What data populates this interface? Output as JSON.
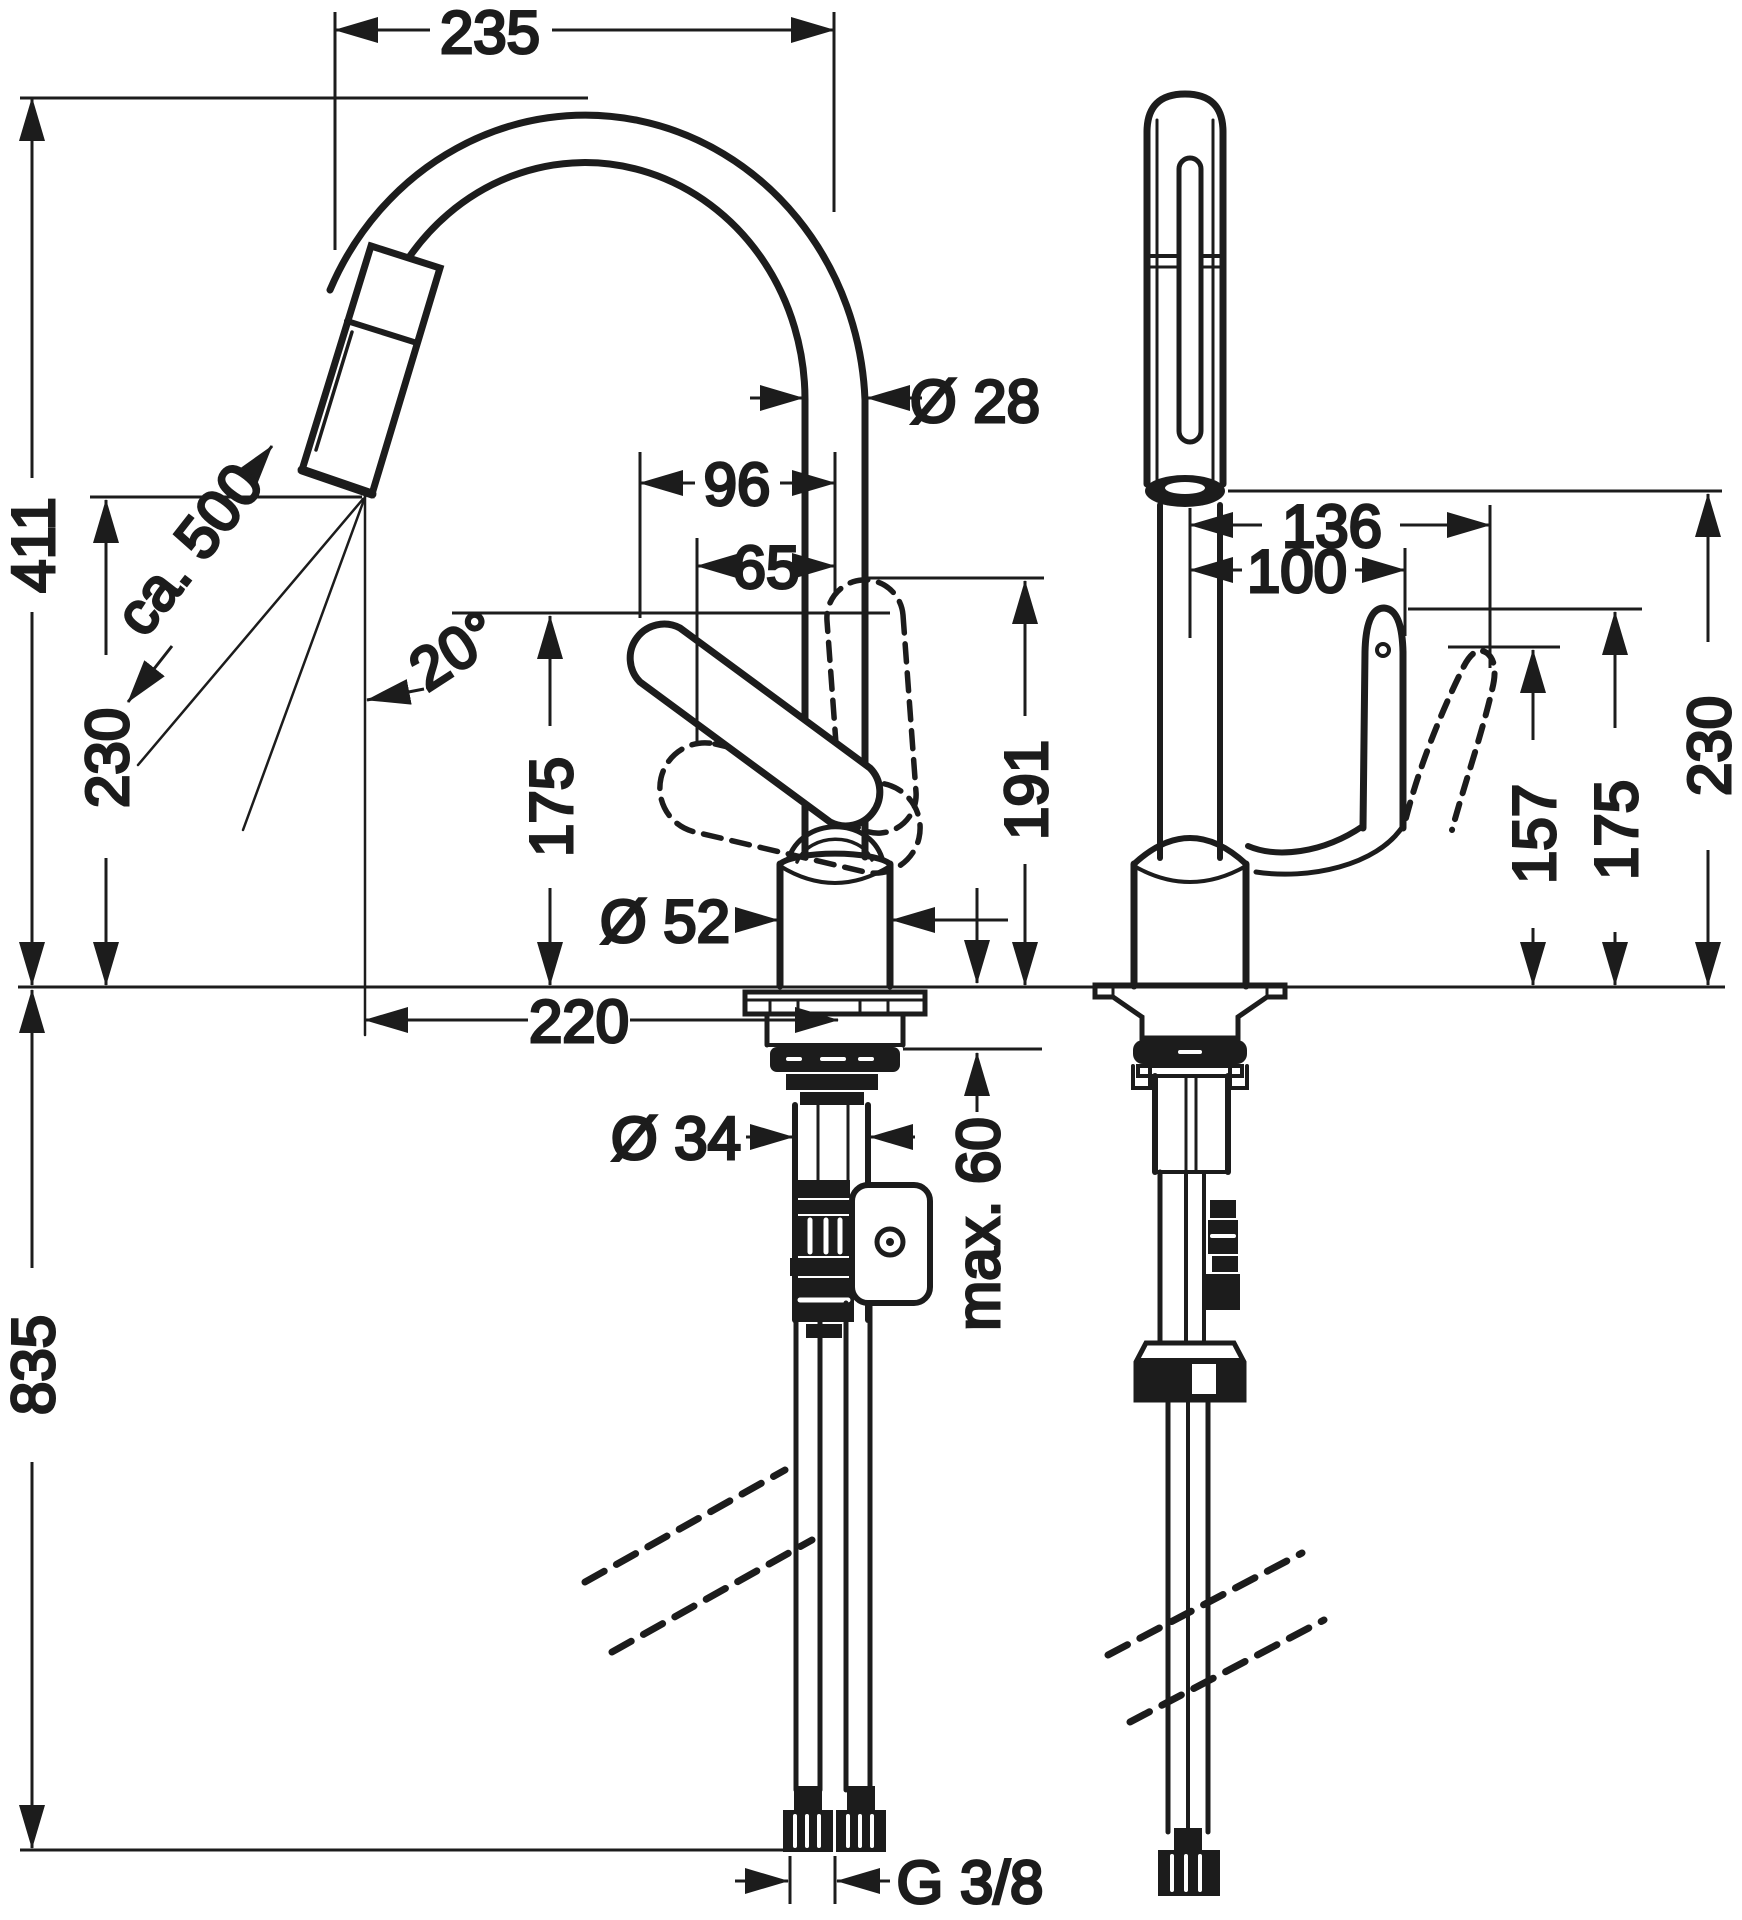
{
  "colors": {
    "ink": "#1c1c1c",
    "background": "#ffffff"
  },
  "dimensions": {
    "front": {
      "spout_reach": "235",
      "total_height": "411",
      "outlet_height": "230",
      "hose_length": "ca. 500",
      "swivel_angle": "20°",
      "spout_diameter": "Ø 28",
      "handle_width_96": "96",
      "handle_width_65": "65",
      "spout_underside_height": "175",
      "handle_top_height": "191",
      "body_diameter": "Ø 52",
      "projection": "220",
      "shank_diameter": "Ø 34",
      "max_counter_thickness": "max. 60",
      "hose_below_counter": "835",
      "connection_thread": "G 3/8"
    },
    "side": {
      "reach_136": "136",
      "reach_100": "100",
      "handle_height_157": "157",
      "handle_height_175": "175",
      "outlet_height_230": "230"
    }
  }
}
